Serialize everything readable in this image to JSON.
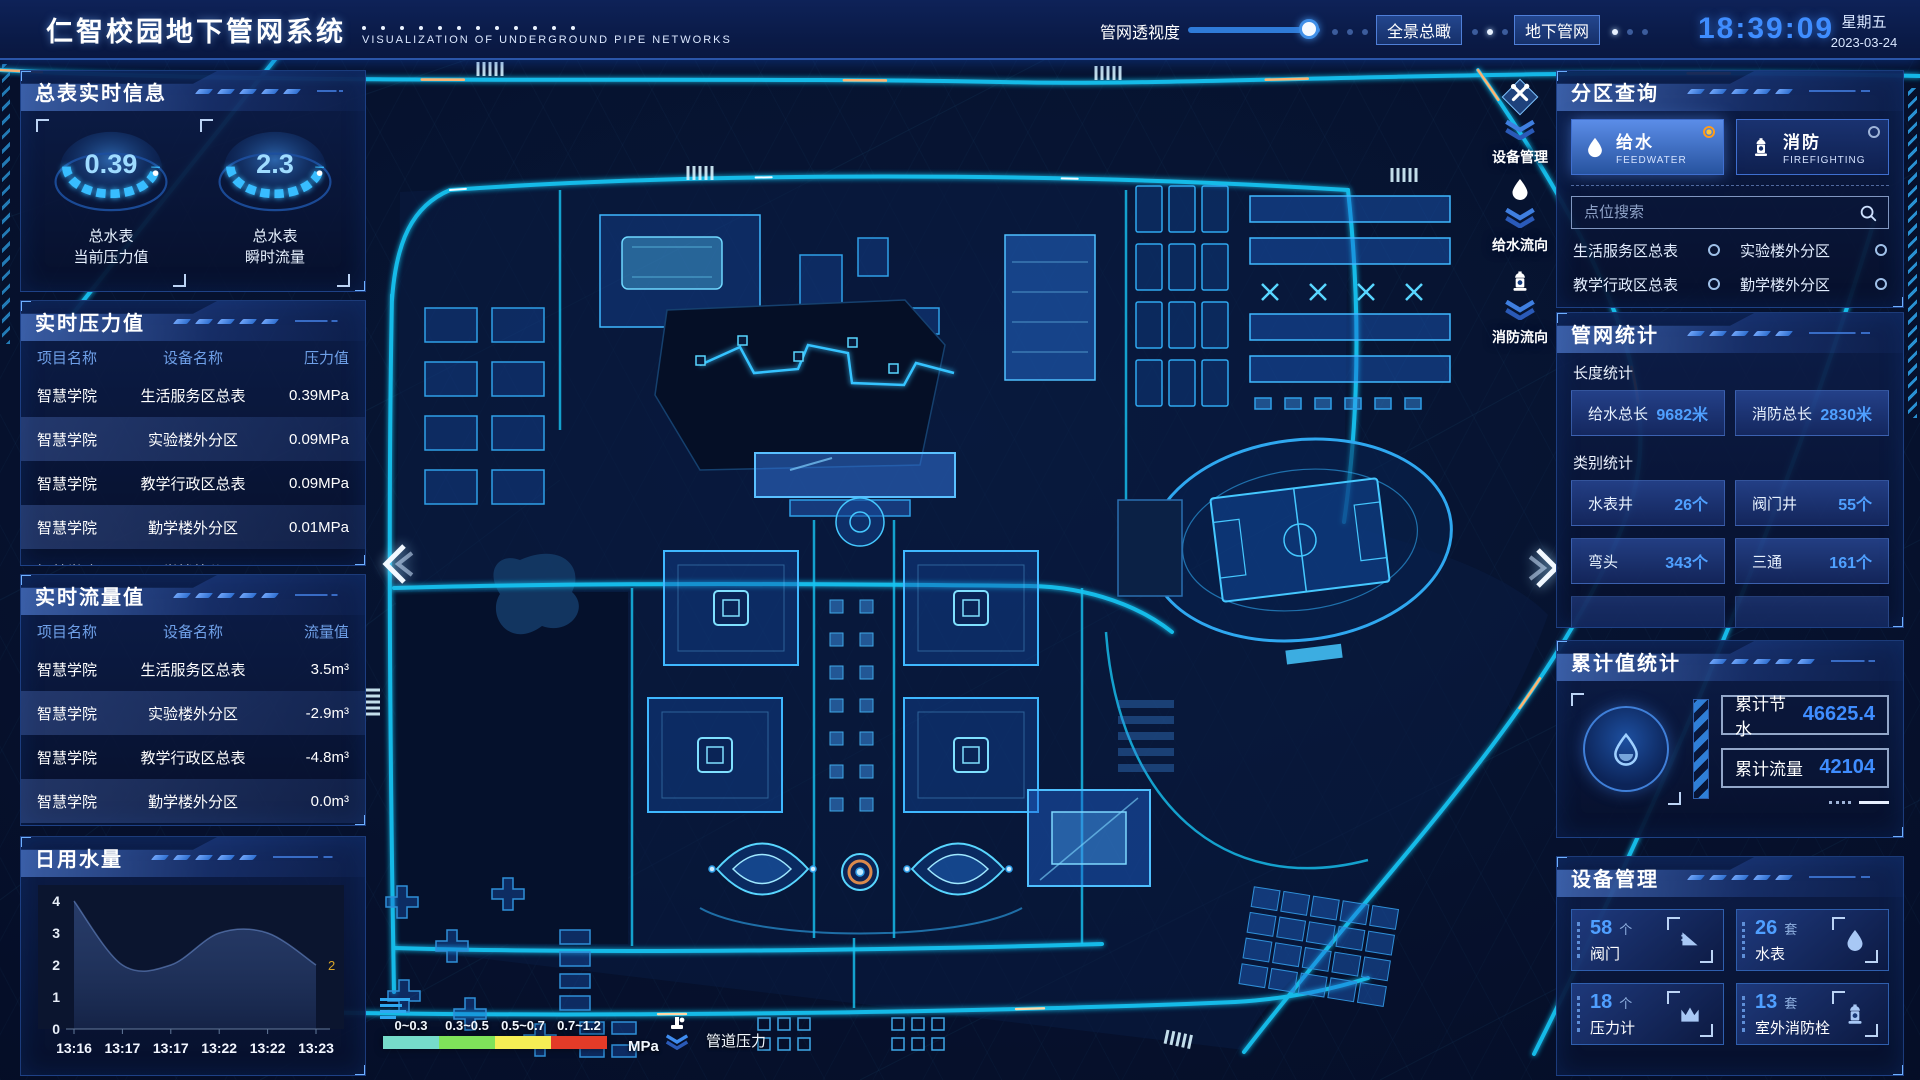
{
  "header": {
    "title": "仁智校园地下管网系统",
    "subtitle": "VISUALIZATION OF UNDERGROUND PIPE NETWORKS",
    "transparency_label": "管网透视度",
    "transparency_percent": 92,
    "nav_buttons": [
      {
        "label": "全景总瞰"
      },
      {
        "label": "地下管网"
      }
    ],
    "clock": {
      "time": "18:39:09",
      "weekday": "星期五",
      "date": "2023-03-24"
    }
  },
  "left_panels": {
    "meter": {
      "title": "总表实时信息",
      "gauges": [
        {
          "value": "0.39",
          "label_line1": "总水表",
          "label_line2": "当前压力值"
        },
        {
          "value": "2.3",
          "label_line1": "总水表",
          "label_line2": "瞬时流量"
        }
      ]
    },
    "pressure": {
      "title": "实时压力值",
      "columns": [
        "项目名称",
        "设备名称",
        "压力值"
      ],
      "rows": [
        [
          "智慧学院",
          "生活服务区总表",
          "0.39MPa"
        ],
        [
          "智慧学院",
          "实验楼外分区",
          "0.09MPa"
        ],
        [
          "智慧学院",
          "教学行政区总表",
          "0.09MPa"
        ],
        [
          "智慧学院",
          "勤学楼外分区",
          "0.01MPa"
        ],
        [
          "智慧学院",
          "砺学楼外分区",
          "0.00MPa"
        ]
      ]
    },
    "flow": {
      "title": "实时流量值",
      "columns": [
        "项目名称",
        "设备名称",
        "流量值"
      ],
      "rows": [
        [
          "智慧学院",
          "生活服务区总表",
          "3.5m³"
        ],
        [
          "智慧学院",
          "实验楼外分区",
          "-2.9m³"
        ],
        [
          "智慧学院",
          "教学行政区总表",
          "-4.8m³"
        ],
        [
          "智慧学院",
          "勤学楼外分区",
          "0.0m³"
        ],
        [
          "智慧学院",
          "砺学楼外分区",
          "-2.3m³"
        ]
      ]
    },
    "daily": {
      "title": "日用水量"
    }
  },
  "chart_data": {
    "type": "area",
    "title": "日用水量",
    "x": [
      "13:16",
      "13:17",
      "13:17",
      "13:22",
      "13:22",
      "13:23"
    ],
    "values": [
      4,
      2,
      2,
      3,
      3,
      2
    ],
    "ylim": [
      0,
      4
    ],
    "yticks": [
      0,
      1,
      2,
      3,
      4
    ],
    "end_label": "2",
    "end_label_color": "#d8a428",
    "grid": false
  },
  "map": {
    "float_buttons": [
      {
        "label": "设备管理",
        "icon": "tools-icon"
      },
      {
        "label": "给水流向",
        "icon": "water-drop-icon"
      },
      {
        "label": "消防流向",
        "icon": "hydrant-icon"
      }
    ],
    "legend": {
      "ranges": [
        "0~0.3",
        "0.3~0.5",
        "0.5~0.7",
        "0.7~1.2"
      ],
      "colors": [
        "#76dcca",
        "#7fe35a",
        "#f5ee55",
        "#e33b28"
      ],
      "unit": "MPa",
      "pressure_label": "管道压力"
    }
  },
  "right_panels": {
    "zone_query": {
      "title": "分区查询",
      "toggles": [
        {
          "label": "给水",
          "sub": "FEEDWATER",
          "selected": true
        },
        {
          "label": "消防",
          "sub": "FIREFIGHTING",
          "selected": false
        }
      ],
      "search_placeholder": "点位搜索",
      "points": [
        "生活服务区总表",
        "实验楼外分区",
        "教学行政区总表",
        "勤学楼外分区",
        "砺学楼外分区",
        "宿舍区泵房"
      ]
    },
    "network_stats": {
      "title": "管网统计",
      "groups": [
        {
          "label": "长度统计",
          "items": [
            {
              "name": "给水总长",
              "value": "9682米"
            },
            {
              "name": "消防总长",
              "value": "2830米"
            }
          ]
        },
        {
          "label": "类别统计",
          "items": [
            {
              "name": "水表井",
              "value": "26个"
            },
            {
              "name": "阀门井",
              "value": "55个"
            },
            {
              "name": "弯头",
              "value": "343个"
            },
            {
              "name": "三通",
              "value": "161个"
            }
          ]
        }
      ]
    },
    "cumulative": {
      "title": "累计值统计",
      "items": [
        {
          "name": "累计节水",
          "value": "46625.4"
        },
        {
          "name": "累计流量",
          "value": "42104"
        }
      ]
    },
    "equipment": {
      "title": "设备管理",
      "cards": [
        {
          "count": "58",
          "unit": "个",
          "name": "阀门",
          "icon": "valve-icon"
        },
        {
          "count": "26",
          "unit": "套",
          "name": "水表",
          "icon": "water-meter-icon"
        },
        {
          "count": "18",
          "unit": "个",
          "name": "压力计",
          "icon": "pressure-gauge-icon"
        },
        {
          "count": "13",
          "unit": "套",
          "name": "室外消防栓",
          "icon": "hydrant-icon"
        }
      ]
    }
  }
}
